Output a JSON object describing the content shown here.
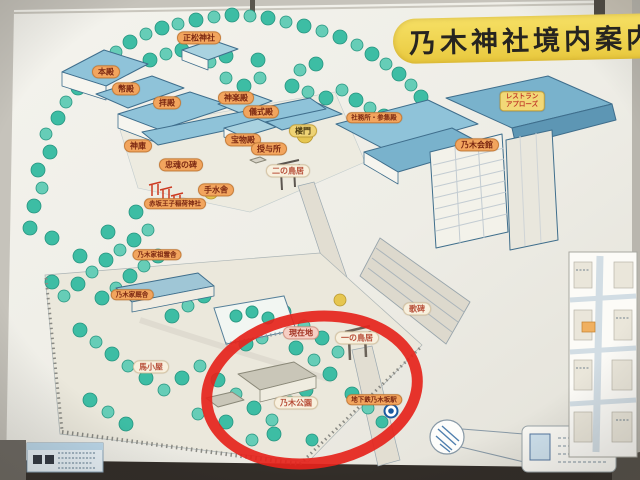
{
  "sign": {
    "title": "乃木神社境内案内図"
  },
  "map_labels": {
    "seisho_jinja": "正松神社",
    "honden": "本殿",
    "heiden": "幣殿",
    "haiden": "拝殿",
    "kaguraden": "神楽殿",
    "gishikiden": "儀式殿",
    "romon": "楼門",
    "shamusho_sanshuden": "社務所・参集殿",
    "homotsuden": "宝物殿",
    "juyosho": "授与所",
    "shinko": "神庫",
    "chukon_no_hi": "忠魂の碑",
    "akasaka_oji_inari_jinja": "赤坂王子稲荷神社",
    "ni_no_torii": "二の鳥居",
    "temizuya": "手水舎",
    "nogike_soreisha": "乃木家祖霊舎",
    "nogike_kyusha": "乃木家厩舎",
    "umagoya": "馬小屋",
    "genzaichi": "現在地",
    "ichi_no_torii": "一の鳥居",
    "nogi_koen": "乃木公園",
    "chikatetsu_nogizaka_eki": "地下鉄乃木坂駅",
    "kahi": "歌碑",
    "restaurant_line1": "レストラン",
    "restaurant_line2": "アプローズ",
    "nogi_kaikan": "乃木会館"
  },
  "colors": {
    "title_banner": "#f0d64e",
    "label_orange": "#f2a55e",
    "label_text": "#7c2812",
    "highlight_red": "#e5231b",
    "roof_blue": "#8fc3d9",
    "tree_green": "#3dbda4",
    "metro_blue": "#1a5aa0"
  }
}
